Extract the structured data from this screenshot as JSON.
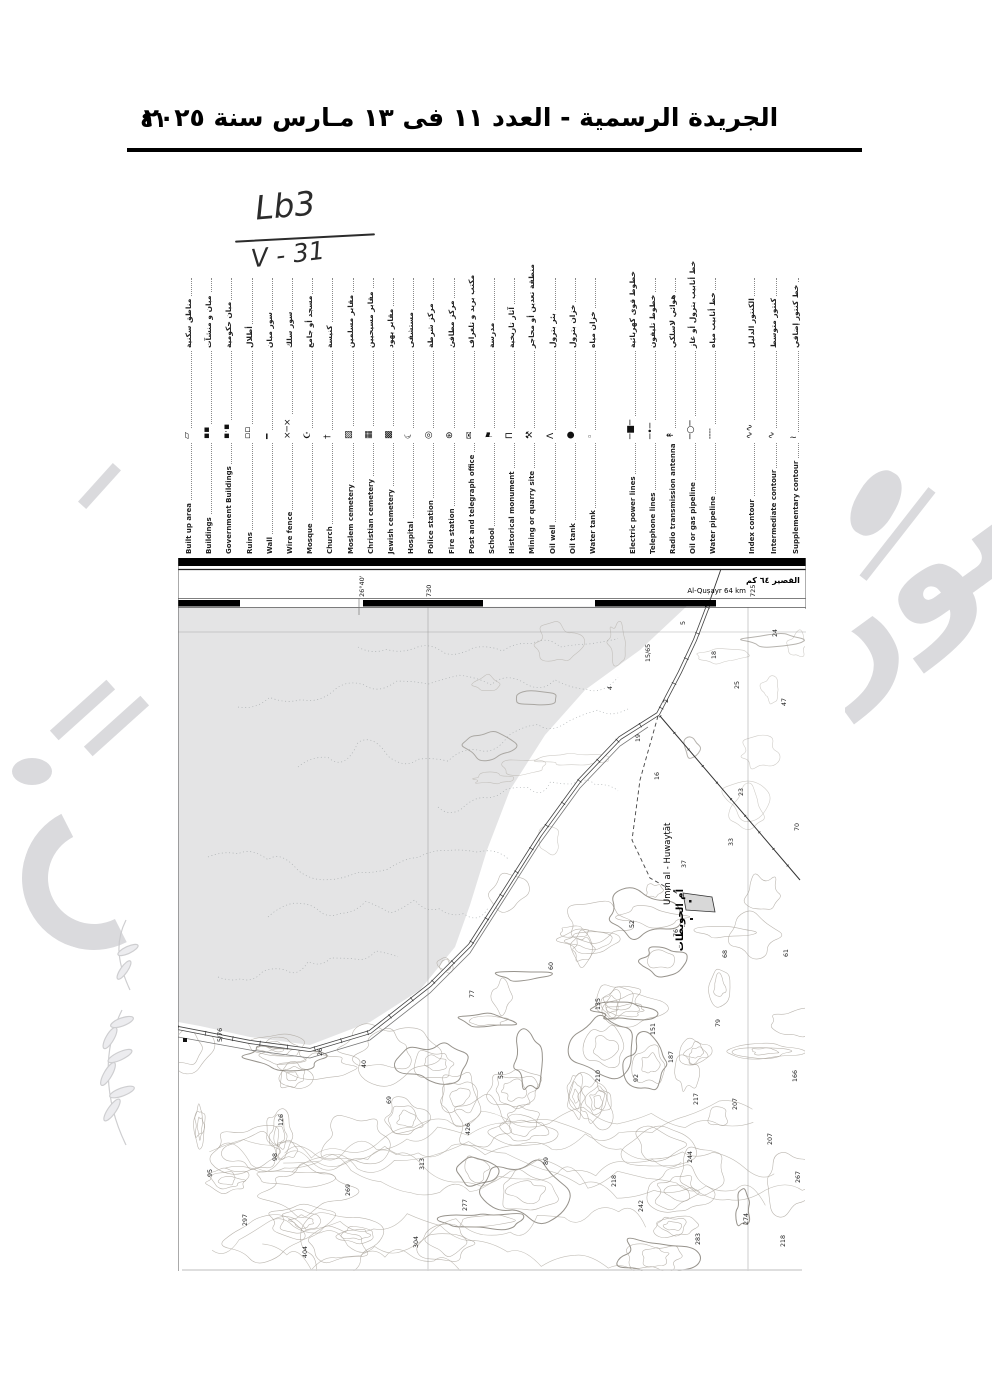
{
  "header": {
    "title": "الجريدة الرسمية - العدد ١١ فى ١٣ مـارس سنة ٢٠٢٥",
    "page_number": "٤١"
  },
  "annotation": {
    "line1": "Lb3",
    "line2": "V - 31"
  },
  "watermark": {
    "text": "صورة"
  },
  "legend": {
    "items": [
      {
        "name": "built-up-area",
        "ar": "مناطق سكنية",
        "en": "Built up area",
        "sym": "▱"
      },
      {
        "name": "buildings",
        "ar": "مبان و منشآت",
        "en": "Buildings",
        "sym": "▪▪"
      },
      {
        "name": "government-buildings",
        "ar": "مبان حكومية",
        "en": "Government Buildings",
        "sym": "▪·▪"
      },
      {
        "name": "ruins",
        "ar": "أطلال",
        "en": "Ruins",
        "sym": "▫▫"
      },
      {
        "name": "wall",
        "ar": "سور مبان",
        "en": "Wall",
        "sym": "━"
      },
      {
        "name": "wire-fence",
        "ar": "سور سلك",
        "en": "Wire fence",
        "sym": "×─×"
      },
      {
        "name": "mosque",
        "ar": "مسجد أو جامع",
        "en": "Mosque",
        "sym": "☪"
      },
      {
        "name": "church",
        "ar": "كنيسة",
        "en": "Church",
        "sym": "†"
      },
      {
        "name": "moslem-cemetery",
        "ar": "مقابر مسلمين",
        "en": "Moslem cemetery",
        "sym": "▨"
      },
      {
        "name": "christian-cemetery",
        "ar": "مقابر مسيحيين",
        "en": "Christian cemetery",
        "sym": "▦"
      },
      {
        "name": "jewish-cemetery",
        "ar": "مقابر يهود",
        "en": "Jewish cemetery",
        "sym": "▩"
      },
      {
        "name": "hospital",
        "ar": "مستشفى",
        "en": "Hospital",
        "sym": "☾"
      },
      {
        "name": "police-station",
        "ar": "مركز شرطة",
        "en": "Police station",
        "sym": "◎"
      },
      {
        "name": "fire-station",
        "ar": "مركز مطافئ",
        "en": "Fire station",
        "sym": "⊛"
      },
      {
        "name": "post-telegraph-office",
        "ar": "مكتب بريد و تلغراف",
        "en": "Post and telegraph office",
        "sym": "✉"
      },
      {
        "name": "school",
        "ar": "مدرسة",
        "en": "School",
        "sym": "⚑"
      },
      {
        "name": "historical-monument",
        "ar": "آثار تاريخية",
        "en": "Historical monument",
        "sym": "Π"
      },
      {
        "name": "mining-quarry-site",
        "ar": "منطقة تعدين أو محاجر",
        "en": "Mining or quarry site",
        "sym": "⚒"
      },
      {
        "name": "oil-well",
        "ar": "بئر بترول",
        "en": "Oil well",
        "sym": "Λ"
      },
      {
        "name": "oil-tank",
        "ar": "خزان بترول",
        "en": "Oil tank",
        "sym": "●"
      },
      {
        "name": "water-tank",
        "ar": "خزان مياه",
        "en": "Water tank",
        "sym": "◦"
      },
      {
        "name": "electric-power-lines",
        "ar": "خطوط قوى كهربائية",
        "en": "Electric power lines",
        "sym": "─■─"
      },
      {
        "name": "telephone-lines",
        "ar": "خطوط تليفون",
        "en": "Telephone lines",
        "sym": "─•─"
      },
      {
        "name": "radio-transmission-antenna",
        "ar": "هوائي لاسلكي",
        "en": "Radio transmission antenna",
        "sym": "↟"
      },
      {
        "name": "oil-gas-pipeline",
        "ar": "خط أنابيب بترول أو غاز",
        "en": "Oil or gas pipeline",
        "sym": "─○─"
      },
      {
        "name": "water-pipeline",
        "ar": "خط أنابيب مياه",
        "en": "Water pipeline",
        "sym": "╌╌"
      },
      {
        "name": "index-contour",
        "ar": "الكنتور الدليل",
        "en": "Index contour",
        "sym": "∿∿"
      },
      {
        "name": "intermediate-contour",
        "ar": "كنتور متوسط",
        "en": "Intermediate contour",
        "sym": "∿"
      },
      {
        "name": "supplementary-contour",
        "ar": "خط كنتور إضافي",
        "en": "Supplementary contour",
        "sym": "≀"
      }
    ]
  },
  "map": {
    "border_labels": {
      "graticule": "26°40'",
      "grid_left": "730",
      "grid_right": "725",
      "destination_ar": "القصير ٦٤ كم",
      "destination_en": "Al-Quṣayr 64 km"
    },
    "place": {
      "ar": "أم الحويطات",
      "en": "Umm al - Huwayṭāt"
    },
    "road_markers": [
      "15/65",
      "5/76"
    ],
    "spot_heights": [
      [
        507,
        68,
        "5"
      ],
      [
        472,
        105,
        "15/65"
      ],
      [
        434,
        133,
        "4"
      ],
      [
        490,
        146,
        "2"
      ],
      [
        462,
        185,
        "19"
      ],
      [
        538,
        102,
        "18"
      ],
      [
        561,
        132,
        "25"
      ],
      [
        599,
        80,
        "24"
      ],
      [
        608,
        149,
        "47"
      ],
      [
        481,
        223,
        "16"
      ],
      [
        565,
        239,
        "23"
      ],
      [
        621,
        274,
        "70"
      ],
      [
        555,
        289,
        "33"
      ],
      [
        508,
        311,
        "37"
      ],
      [
        456,
        371,
        "52"
      ],
      [
        500,
        380,
        "76"
      ],
      [
        549,
        401,
        "68"
      ],
      [
        610,
        400,
        "61"
      ],
      [
        44,
        485,
        "5/76"
      ],
      [
        144,
        499,
        "26"
      ],
      [
        188,
        511,
        "40"
      ],
      [
        213,
        547,
        "69"
      ],
      [
        296,
        441,
        "77"
      ],
      [
        325,
        522,
        "55"
      ],
      [
        375,
        413,
        "60"
      ],
      [
        105,
        569,
        "126"
      ],
      [
        99,
        604,
        "98"
      ],
      [
        34,
        620,
        "95"
      ],
      [
        172,
        639,
        "269"
      ],
      [
        69,
        669,
        "297"
      ],
      [
        246,
        613,
        "313"
      ],
      [
        289,
        654,
        "277"
      ],
      [
        240,
        691,
        "304"
      ],
      [
        292,
        578,
        "426"
      ],
      [
        370,
        608,
        "89"
      ],
      [
        422,
        453,
        "135"
      ],
      [
        477,
        478,
        "151"
      ],
      [
        542,
        470,
        "79"
      ],
      [
        460,
        525,
        "92"
      ],
      [
        495,
        506,
        "187"
      ],
      [
        422,
        525,
        "210"
      ],
      [
        520,
        548,
        "217"
      ],
      [
        559,
        553,
        "207"
      ],
      [
        619,
        525,
        "166"
      ],
      [
        514,
        606,
        "244"
      ],
      [
        594,
        588,
        "207"
      ],
      [
        622,
        626,
        "267"
      ],
      [
        438,
        630,
        "218"
      ],
      [
        465,
        655,
        "242"
      ],
      [
        570,
        668,
        "274"
      ],
      [
        522,
        688,
        "283"
      ],
      [
        129,
        701,
        "404"
      ],
      [
        607,
        690,
        "218"
      ]
    ]
  },
  "colors": {
    "ink": "#111111",
    "scan_gray_area": "#e4e4e5",
    "contour": "#a8a299",
    "contour_index": "#7a746c",
    "watermark": "#dadadd"
  }
}
